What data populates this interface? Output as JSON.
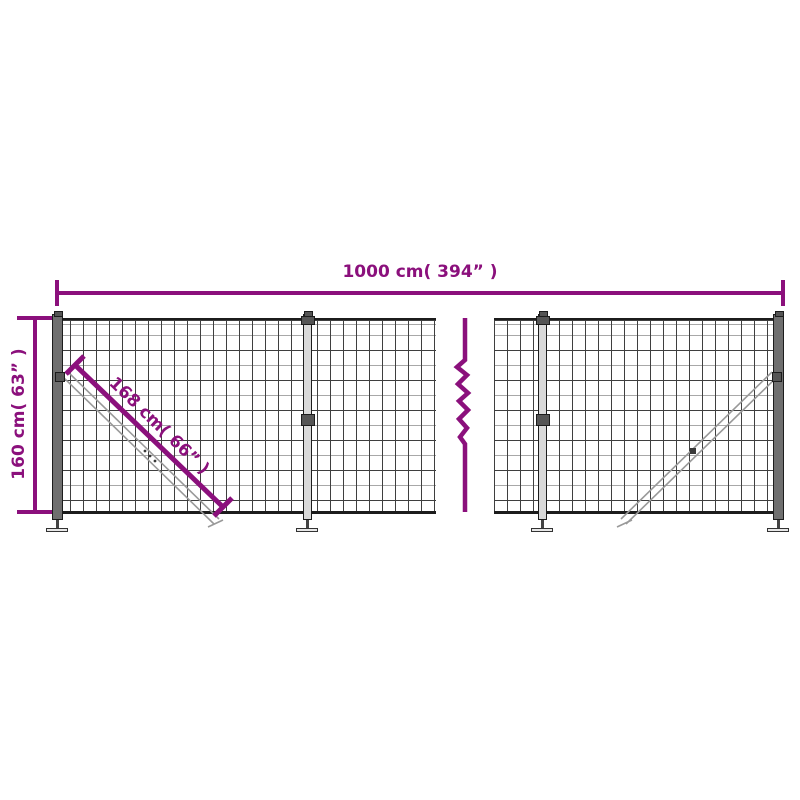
{
  "diagram": {
    "name": "wire-mesh-fence-dimension-diagram",
    "width_dimension": "1000 cm( 394” )",
    "height_dimension": "160 cm( 63” )",
    "diagonal_dimension": "168 cm( 66” )"
  },
  "colors": {
    "accent": "#8B107C",
    "background": "#ffffff",
    "outline": "#1c1c1c",
    "mesh-dark": "#3f3f3f",
    "mesh-light": "#a8a8a8",
    "post-dark": "#6f6f6f",
    "post-light": "#d9d9d9",
    "brace": "#999999"
  }
}
